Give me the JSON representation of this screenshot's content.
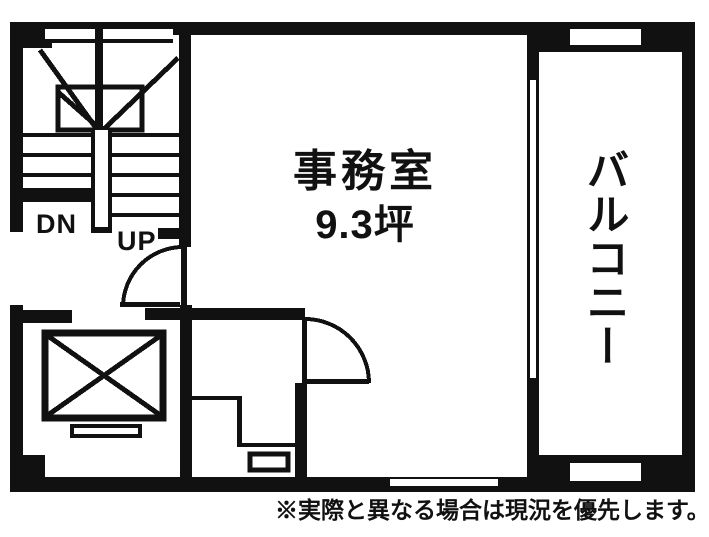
{
  "floor_plan": {
    "office": {
      "name": "事務室",
      "area": "9.3坪"
    },
    "balcony": {
      "label": "バルコニー"
    },
    "stairs": {
      "down_label": "DN",
      "up_label": "UP"
    },
    "note": "※実際と異なる場合は現況を優先します。",
    "colors": {
      "line": "#111111",
      "background": "#ffffff"
    }
  }
}
